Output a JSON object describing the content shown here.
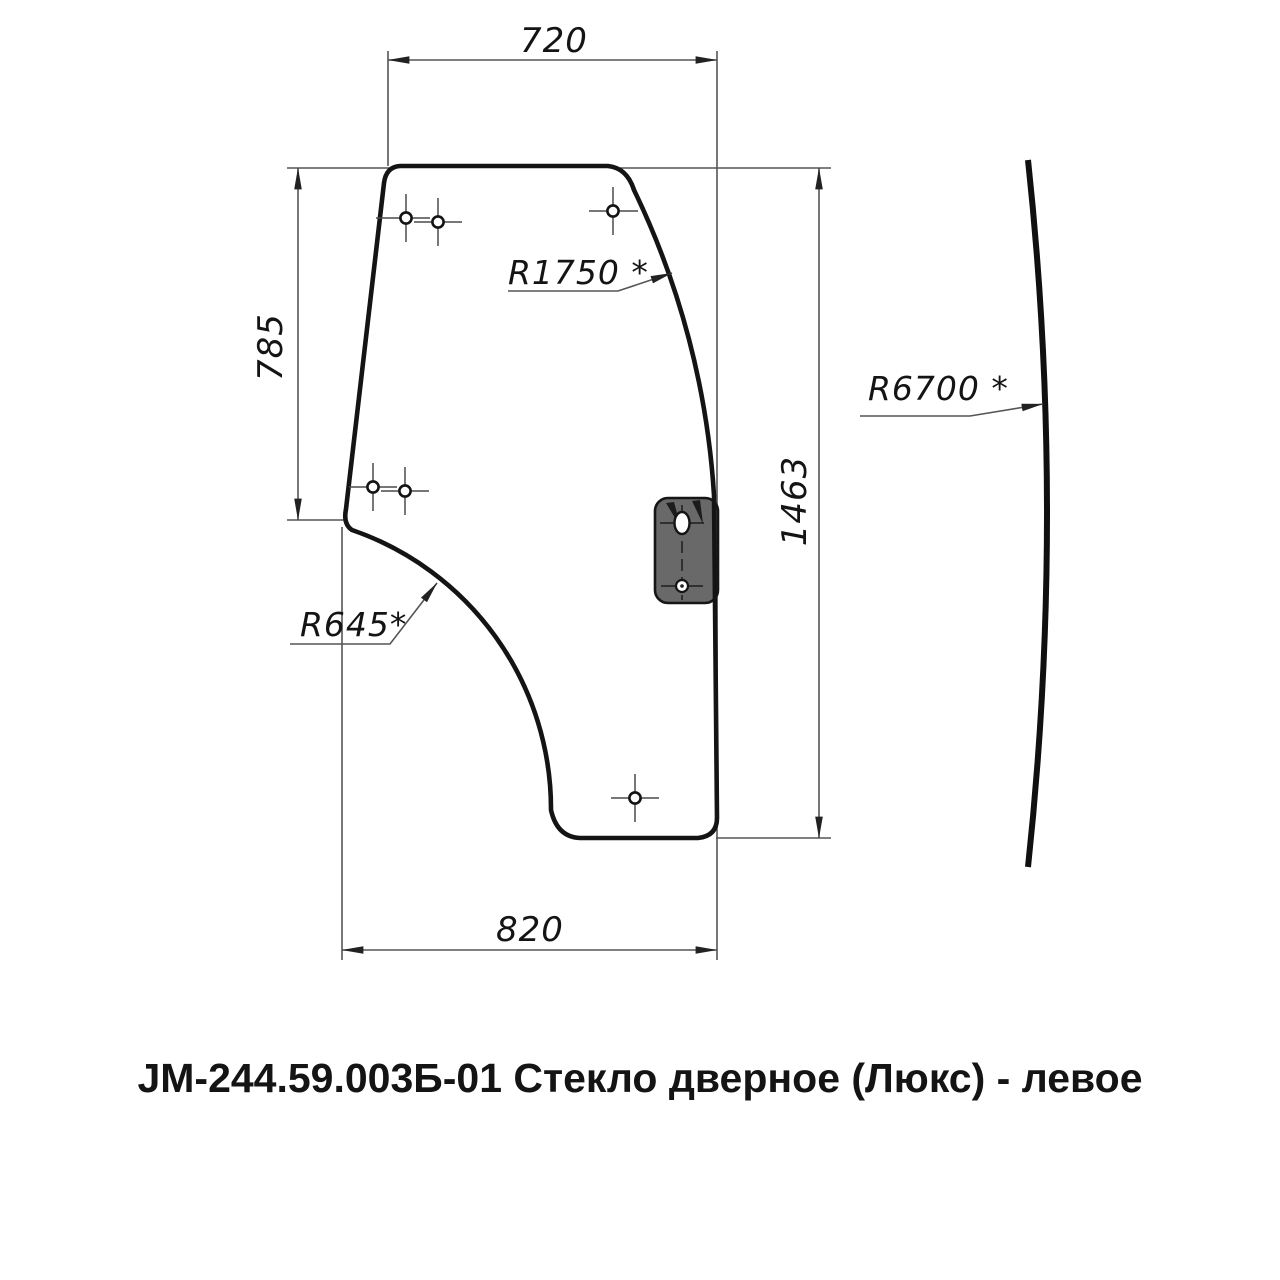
{
  "drawing": {
    "caption": "JM-244.59.003Б-01 Стекло дверное (Люкс) - левое",
    "dimensions": {
      "top_width": "720",
      "left_height": "785",
      "right_height": "1463",
      "bottom_width": "820"
    },
    "radii": {
      "top_edge": "R1750 *",
      "bottom_edge": "R645*",
      "profile": "R6700 *"
    },
    "colors": {
      "outline": "#141414",
      "thin_line": "#555555",
      "cross_line": "#4a4a4a",
      "bracket_fill": "#696969",
      "text": "#141414",
      "background": "#ffffff"
    }
  }
}
